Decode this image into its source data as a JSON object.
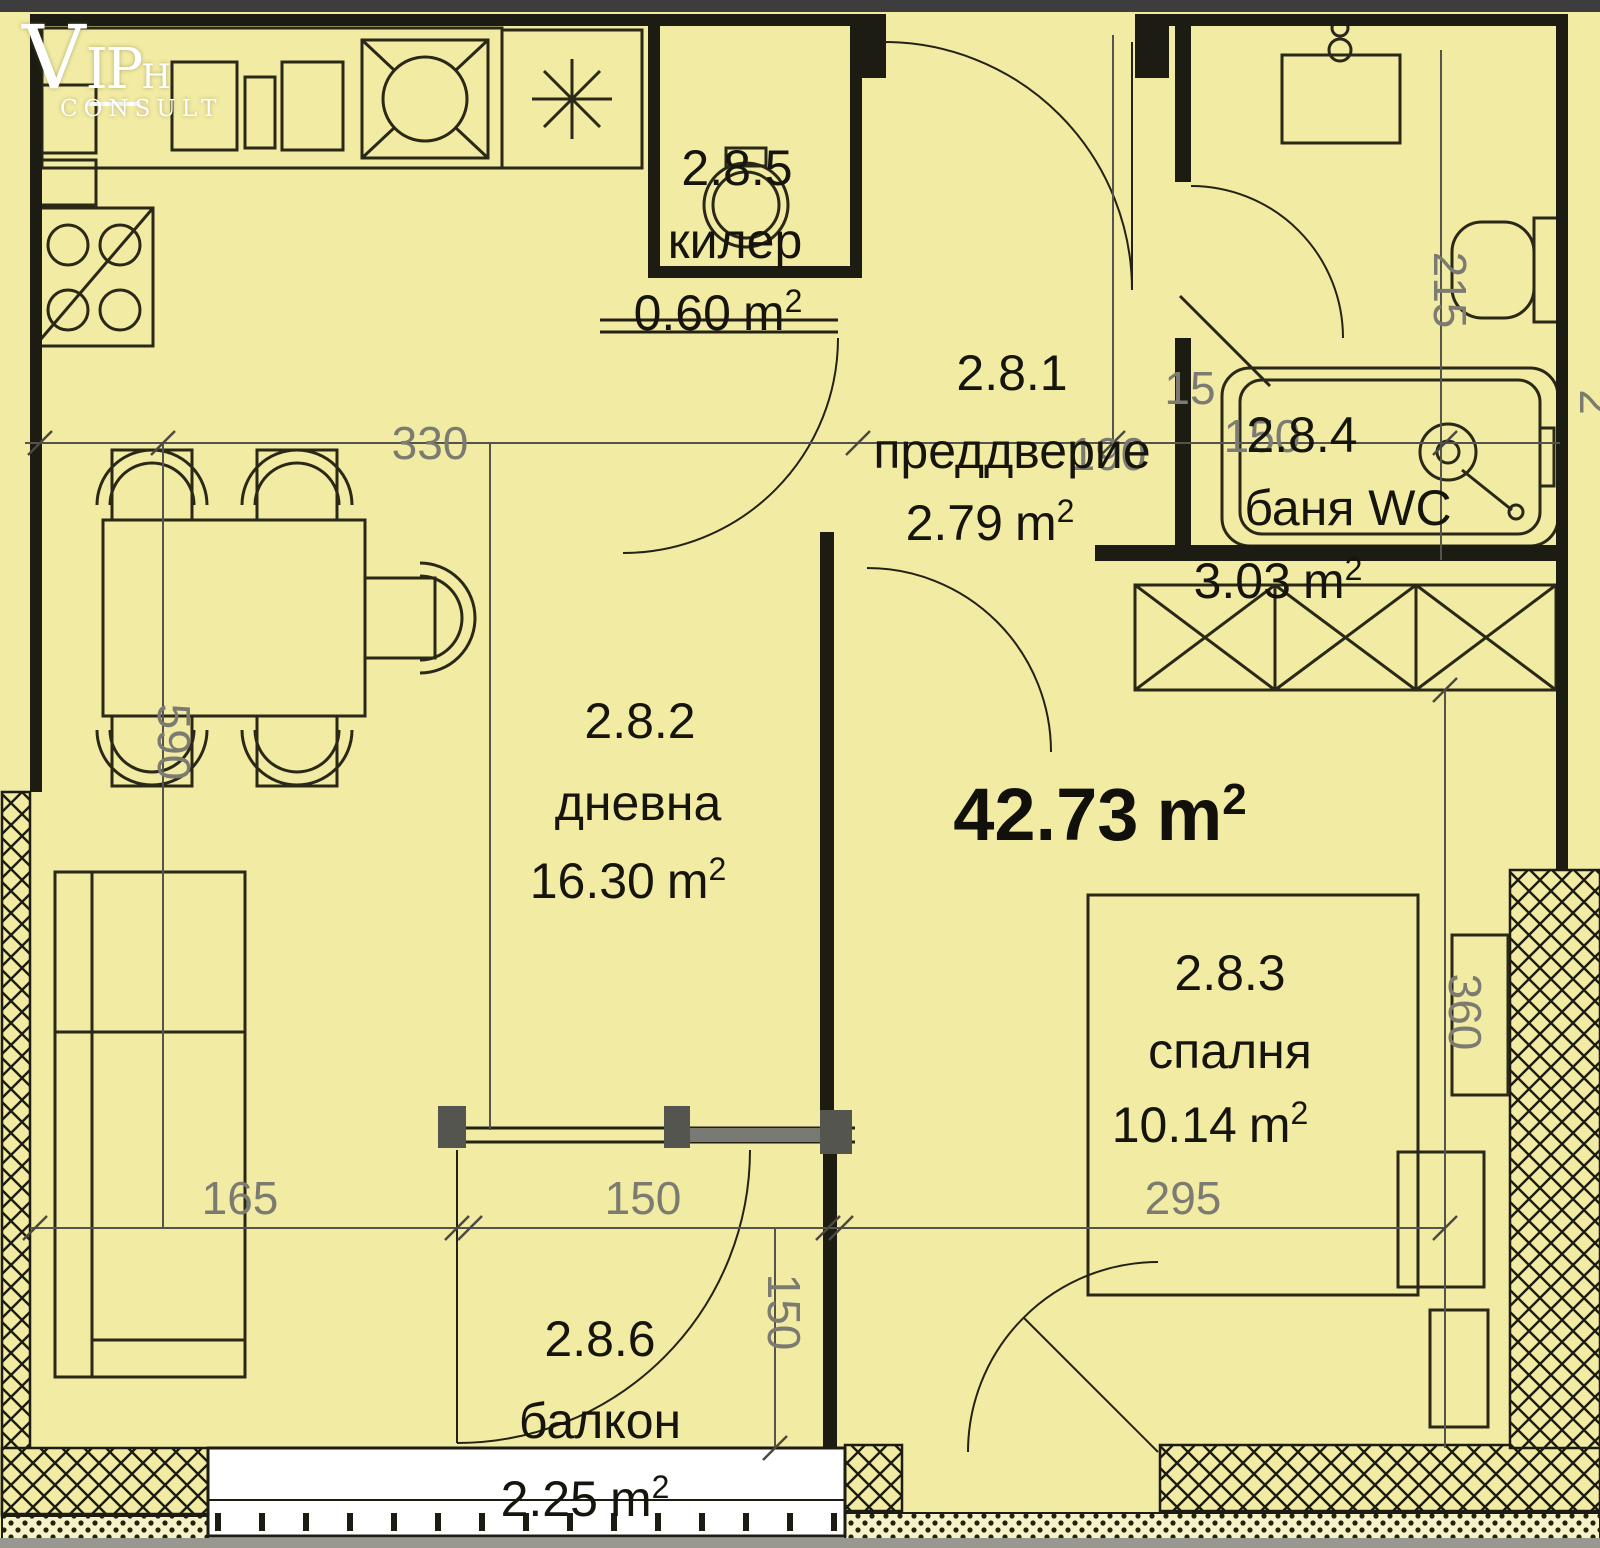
{
  "logo": {
    "part1": "V",
    "part2": "IP",
    "part3": "H",
    "part4": "CONSULT"
  },
  "units": {
    "m": "m",
    "sup": "2"
  },
  "total": {
    "value": "42.73"
  },
  "rooms": [
    {
      "id": "2.8.1",
      "name": "преддверие",
      "area": "2.79"
    },
    {
      "id": "2.8.2",
      "name": "дневна",
      "area": "16.30"
    },
    {
      "id": "2.8.3",
      "name": "спалня",
      "area": "10.14"
    },
    {
      "id": "2.8.4",
      "name": "баня WC",
      "area": "3.03"
    },
    {
      "id": "2.8.5",
      "name": "килер",
      "area": "0.60"
    },
    {
      "id": "2.8.6",
      "name": "балкон",
      "area": "2.25"
    }
  ],
  "dimensions": {
    "top_width": "330",
    "living_height": "590",
    "sofa_width": "165",
    "balcony_door_width": "150",
    "balcony_depth": "150",
    "bedroom_width": "295",
    "bedroom_height": "360",
    "bath_height": "215",
    "bath_width": "150",
    "wall_thickness": "15",
    "hall_width": "190",
    "right_edge_partial": "2"
  }
}
